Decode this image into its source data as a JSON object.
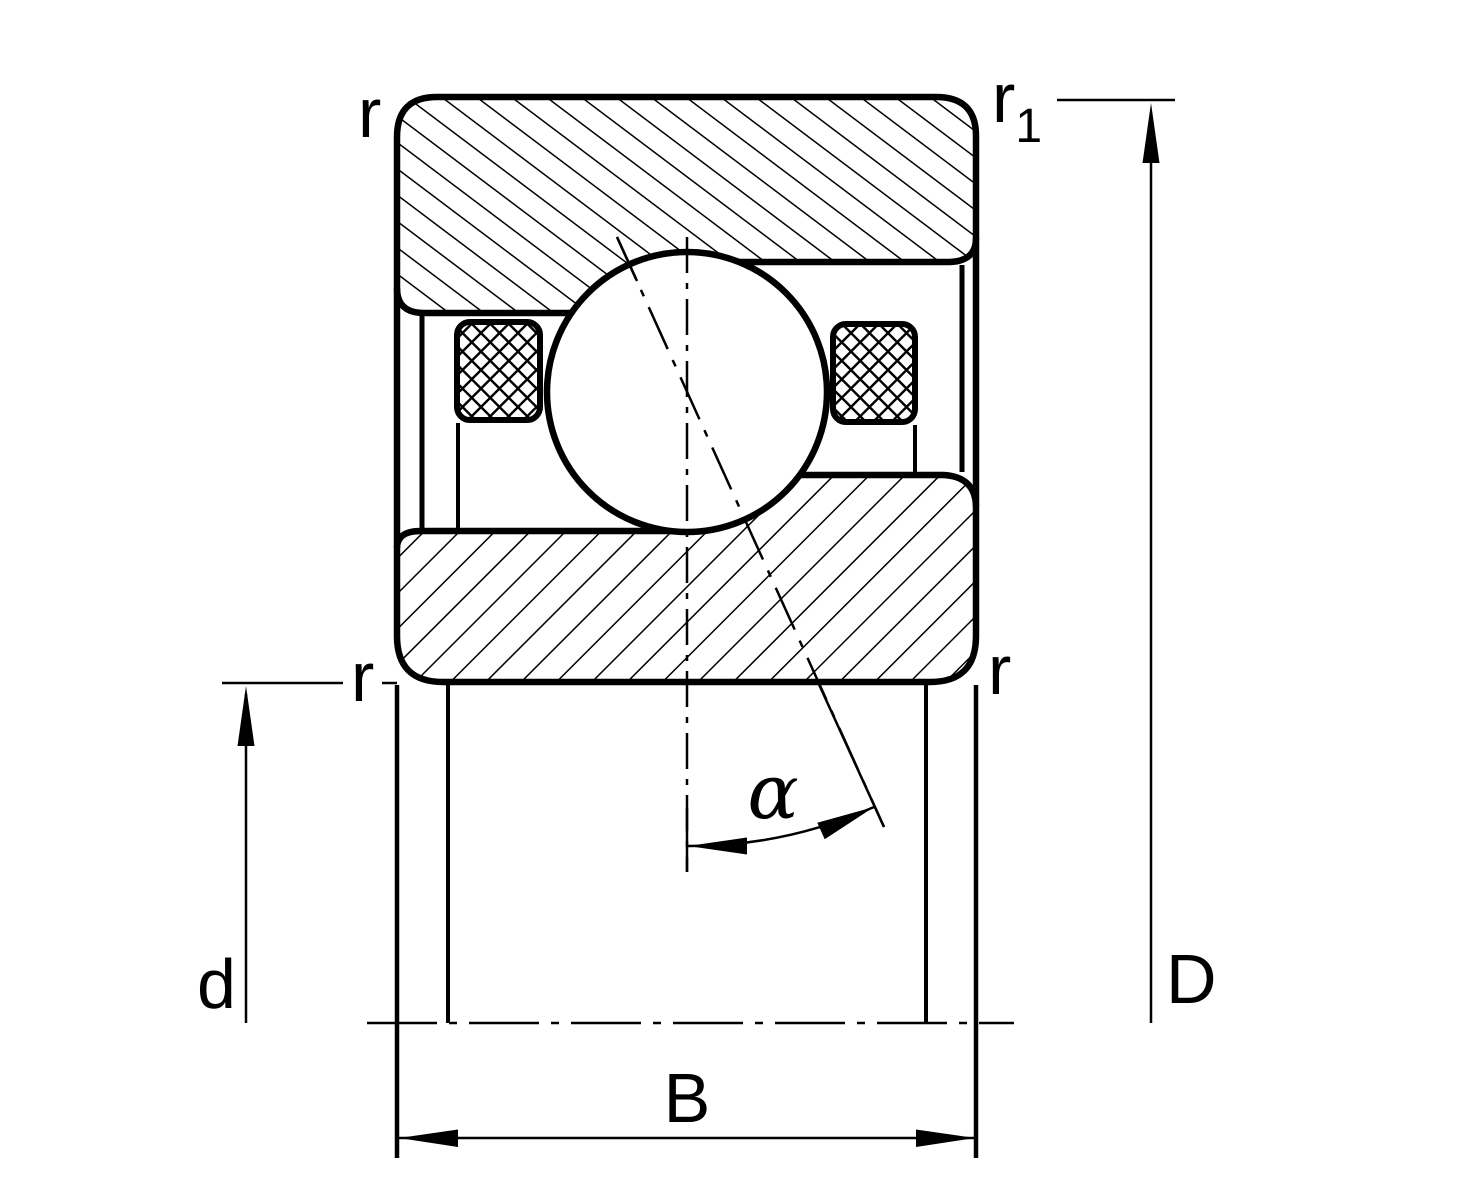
{
  "diagram": {
    "kind": "bearing-cross-section",
    "colors": {
      "line": "#000000",
      "background": "#ffffff"
    },
    "labels": {
      "radius_top_left": "r",
      "radius_top_right_main": "r",
      "radius_top_right_sub": "1",
      "radius_mid_left": "r",
      "radius_mid_right": "r",
      "bore_dimension": "d",
      "outside_dimension": "D",
      "width_dimension": "B",
      "contact_angle": "α"
    }
  }
}
